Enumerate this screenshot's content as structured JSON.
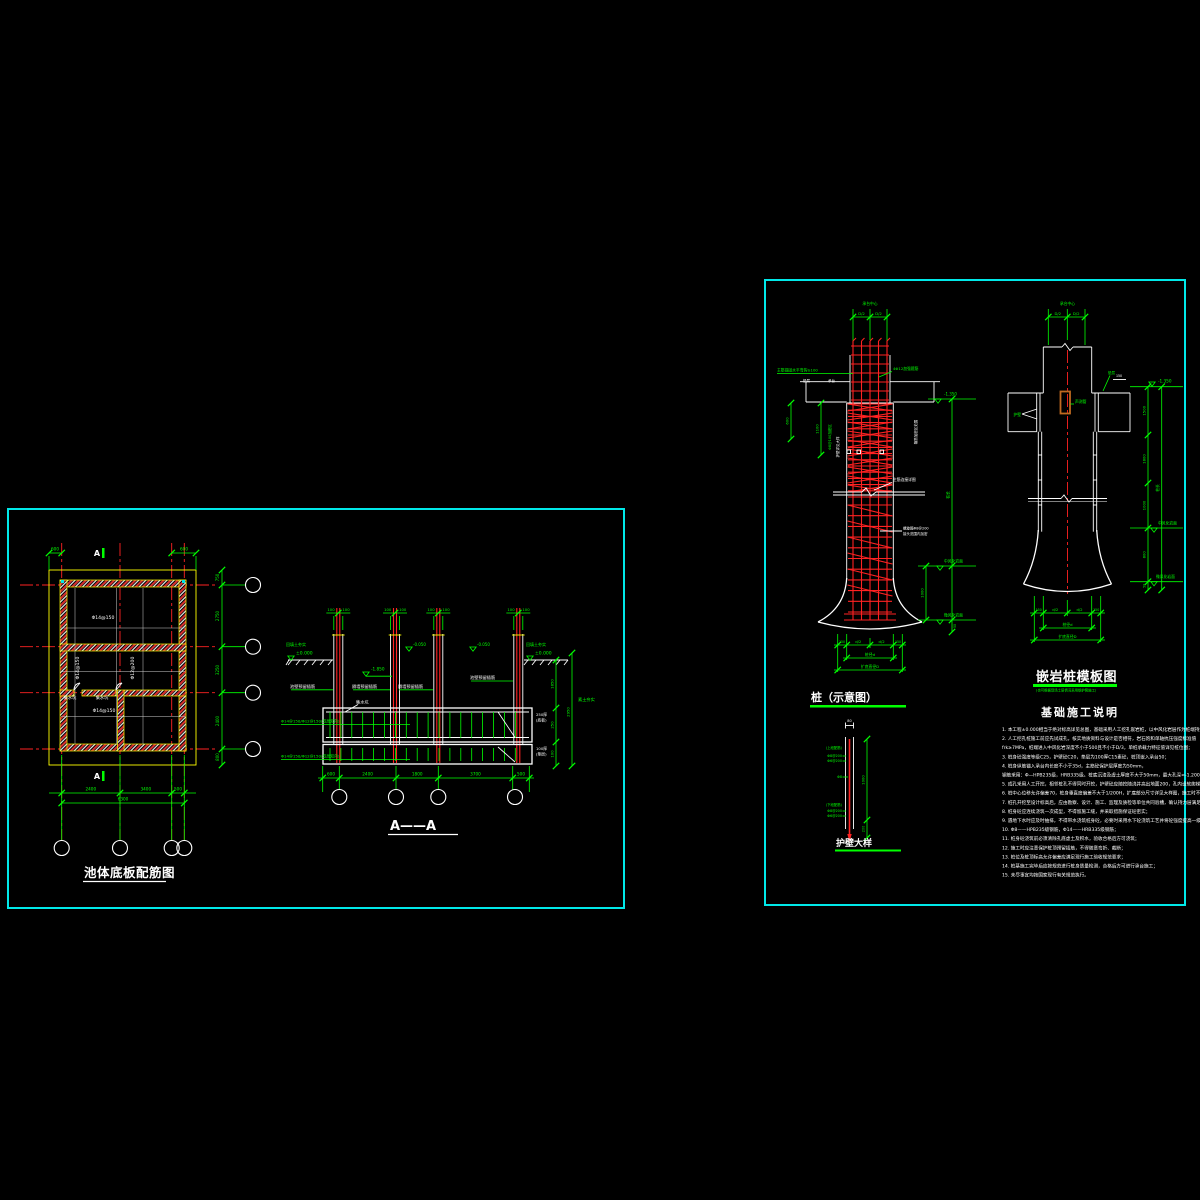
{
  "plan": {
    "title": "池体底板配筋图",
    "rebar_h1": "Φ14@150",
    "rebar_v1": "Φ14@150",
    "rebar_v2": "Φ12@200",
    "rebar_h2": "Φ14@150",
    "sump": "集水坑",
    "marker_a": "A",
    "dim_tl": "600",
    "dim_tr": "600",
    "dims_right": [
      "750",
      "2750",
      "3250",
      "2400",
      "800"
    ],
    "dims_bottom": [
      "2400",
      "3400",
      "500"
    ],
    "dim_total": "6300"
  },
  "section": {
    "title": "A——A",
    "col_dim": "100",
    "elev_zero": "±0.000",
    "elev_wall": "-0.050",
    "elev_mid": "-1.850",
    "ground_label": "回填土夯实",
    "wall_label_side": "池壁预留插筋",
    "wall_label_mid": "隔墙预留插筋",
    "sump": "集水坑",
    "slab_rebar": "Φ14@150/Φ12@150(双层双向)",
    "right_label_1a": "250厚",
    "right_label_1b": "(底板)",
    "right_label_2a": "100厚",
    "right_label_2b": "(垫层)",
    "soil_label": "素土夯实",
    "dims_right": [
      "1850",
      "250",
      "100"
    ],
    "dim_right_total": "2950",
    "dims_bottom": [
      "600",
      "2400",
      "1800",
      "3700",
      "500"
    ]
  },
  "pile_s": {
    "title": "桩（示意图）",
    "top_label": "承台中心",
    "dim_d2": "D/2",
    "anchor_label": "主筋锚固水平弯钩≥100",
    "tie_label": "4Φ12加强箍筋",
    "cap_label_1": "垫层",
    "cap_label_2": "承台",
    "dim_600": "600",
    "dim_1100": "1100",
    "dense_label": "Φ8@100加密区",
    "casing_label": "护壁详见大样",
    "range_label": "箍筋加密区范围",
    "joint_label": "主筋连接详图",
    "spiral_label_1": "螺旋箍Φ8@200",
    "spiral_label_2": "接头范围内加密",
    "elev_top": "-1.350",
    "rock1": "中风化岩面",
    "rock2": "微风化岩面",
    "dim_len": "桩长",
    "dim_1000": "1000",
    "dim_50": "50",
    "dim_150": "150",
    "dim_d2b": "d/2",
    "dim_d": "桩径d",
    "dim_D": "扩底直径D"
  },
  "casing": {
    "title": "护壁大样",
    "dim_80": "80",
    "upper": "(上段配筋)",
    "upper1": "Φ8@200",
    "upper2": "Φ6@200",
    "mid": "Φ8",
    "lower": "(下段配筋)",
    "lower1": "Φ8@200",
    "lower2": "Φ6@200",
    "dim_1000": "1000",
    "dim_200": "200"
  },
  "pile_f": {
    "title": "嵌岩桩模板图",
    "subtitle": "(也可根据现场土层情况采用钢护筒施工)",
    "top_label": "承台中心",
    "dim_d2": "D/2",
    "tube_label": "声测管",
    "casing_label": "护壁",
    "pad_label": "垫层",
    "dim_150t": "150",
    "elev_top": "-1.350",
    "rock1": "中风化岩面",
    "rock2": "微风化岩面",
    "dims_right": [
      "1500",
      "1800",
      "1000",
      "800",
      "50"
    ],
    "dim_len": "桩长",
    "dim_150": "150",
    "dim_d2b": "d/2",
    "dim_d": "桩径d",
    "dim_D": "扩底直径D"
  },
  "notes": {
    "title": "基础施工说明",
    "lines": [
      "1. 本工程±0.000相当于绝对标高详见总图，基础采用人工挖孔嵌岩桩，以中风化岩层作为桩端持力层；",
      "2. 人工挖孔桩施工前应先试成孔，核实地质资料与设计是否相符，岩石饱和单轴抗压强度标准值",
      "   frk≥7MPa，桩端进入中风化岩深度不小于500且不小于D/3，单桩承载力特征值详见桩位图；",
      "3. 桩身砼强度等级C25，护壁砼C20，垫层为100厚C15素砼，桩顶嵌入承台50；",
      "4. 桩身纵筋锚入承台内长度不小于35d，主筋砼保护层厚度为50mm，",
      "   钢筋采用：Φ—HPB235级，HRB335级。桩底沉渣及虚土厚度不大于50mm，最大孔深≈-1.200m；",
      "5. 成孔采用人工开挖，相邻桩孔不得同时开挖，护壁砼应随挖随浇并高出地面200，孔内设软爬梯、安全绳等；",
      "6. 桩中心位移允许偏差70，桩身垂直度偏差不大于1/200H，扩底部分尺寸详见大样图，施工时不得小于设计值；",
      "7. 桩孔开挖至设计标高后，应由勘察、设计、施工、监理及质检等单位共同验槽，确认持力层满足设计要求后方可封底；",
      "8. 桩身砼应连续浇筑一次成型，不得留施工缝，并采取措施保证砼密实；",
      "9. 遇地下水时应及时抽排，不得带水浇筑桩身砼，必要时采用水下砼浇筑工艺并将砼强度提高一级使用；",
      "10. Φ8——HPB235级钢筋，Φ14——HRB335级钢筋；",
      "11. 桩身砼浇筑前必须清除孔底虚土及积水，验收合格后方可浇筑；",
      "12. 施工时应注意保护桩顶预留插筋，不得随意弯折、截断；",
      "13. 桩位及桩顶标高允许偏差应满足现行施工验收规范要求；",
      "14. 桩基施工完毕后应按规范进行桩身质量检测，合格后方可进行承台施工；",
      "15. 未尽事宜均按国家现行有关规范执行。"
    ]
  }
}
